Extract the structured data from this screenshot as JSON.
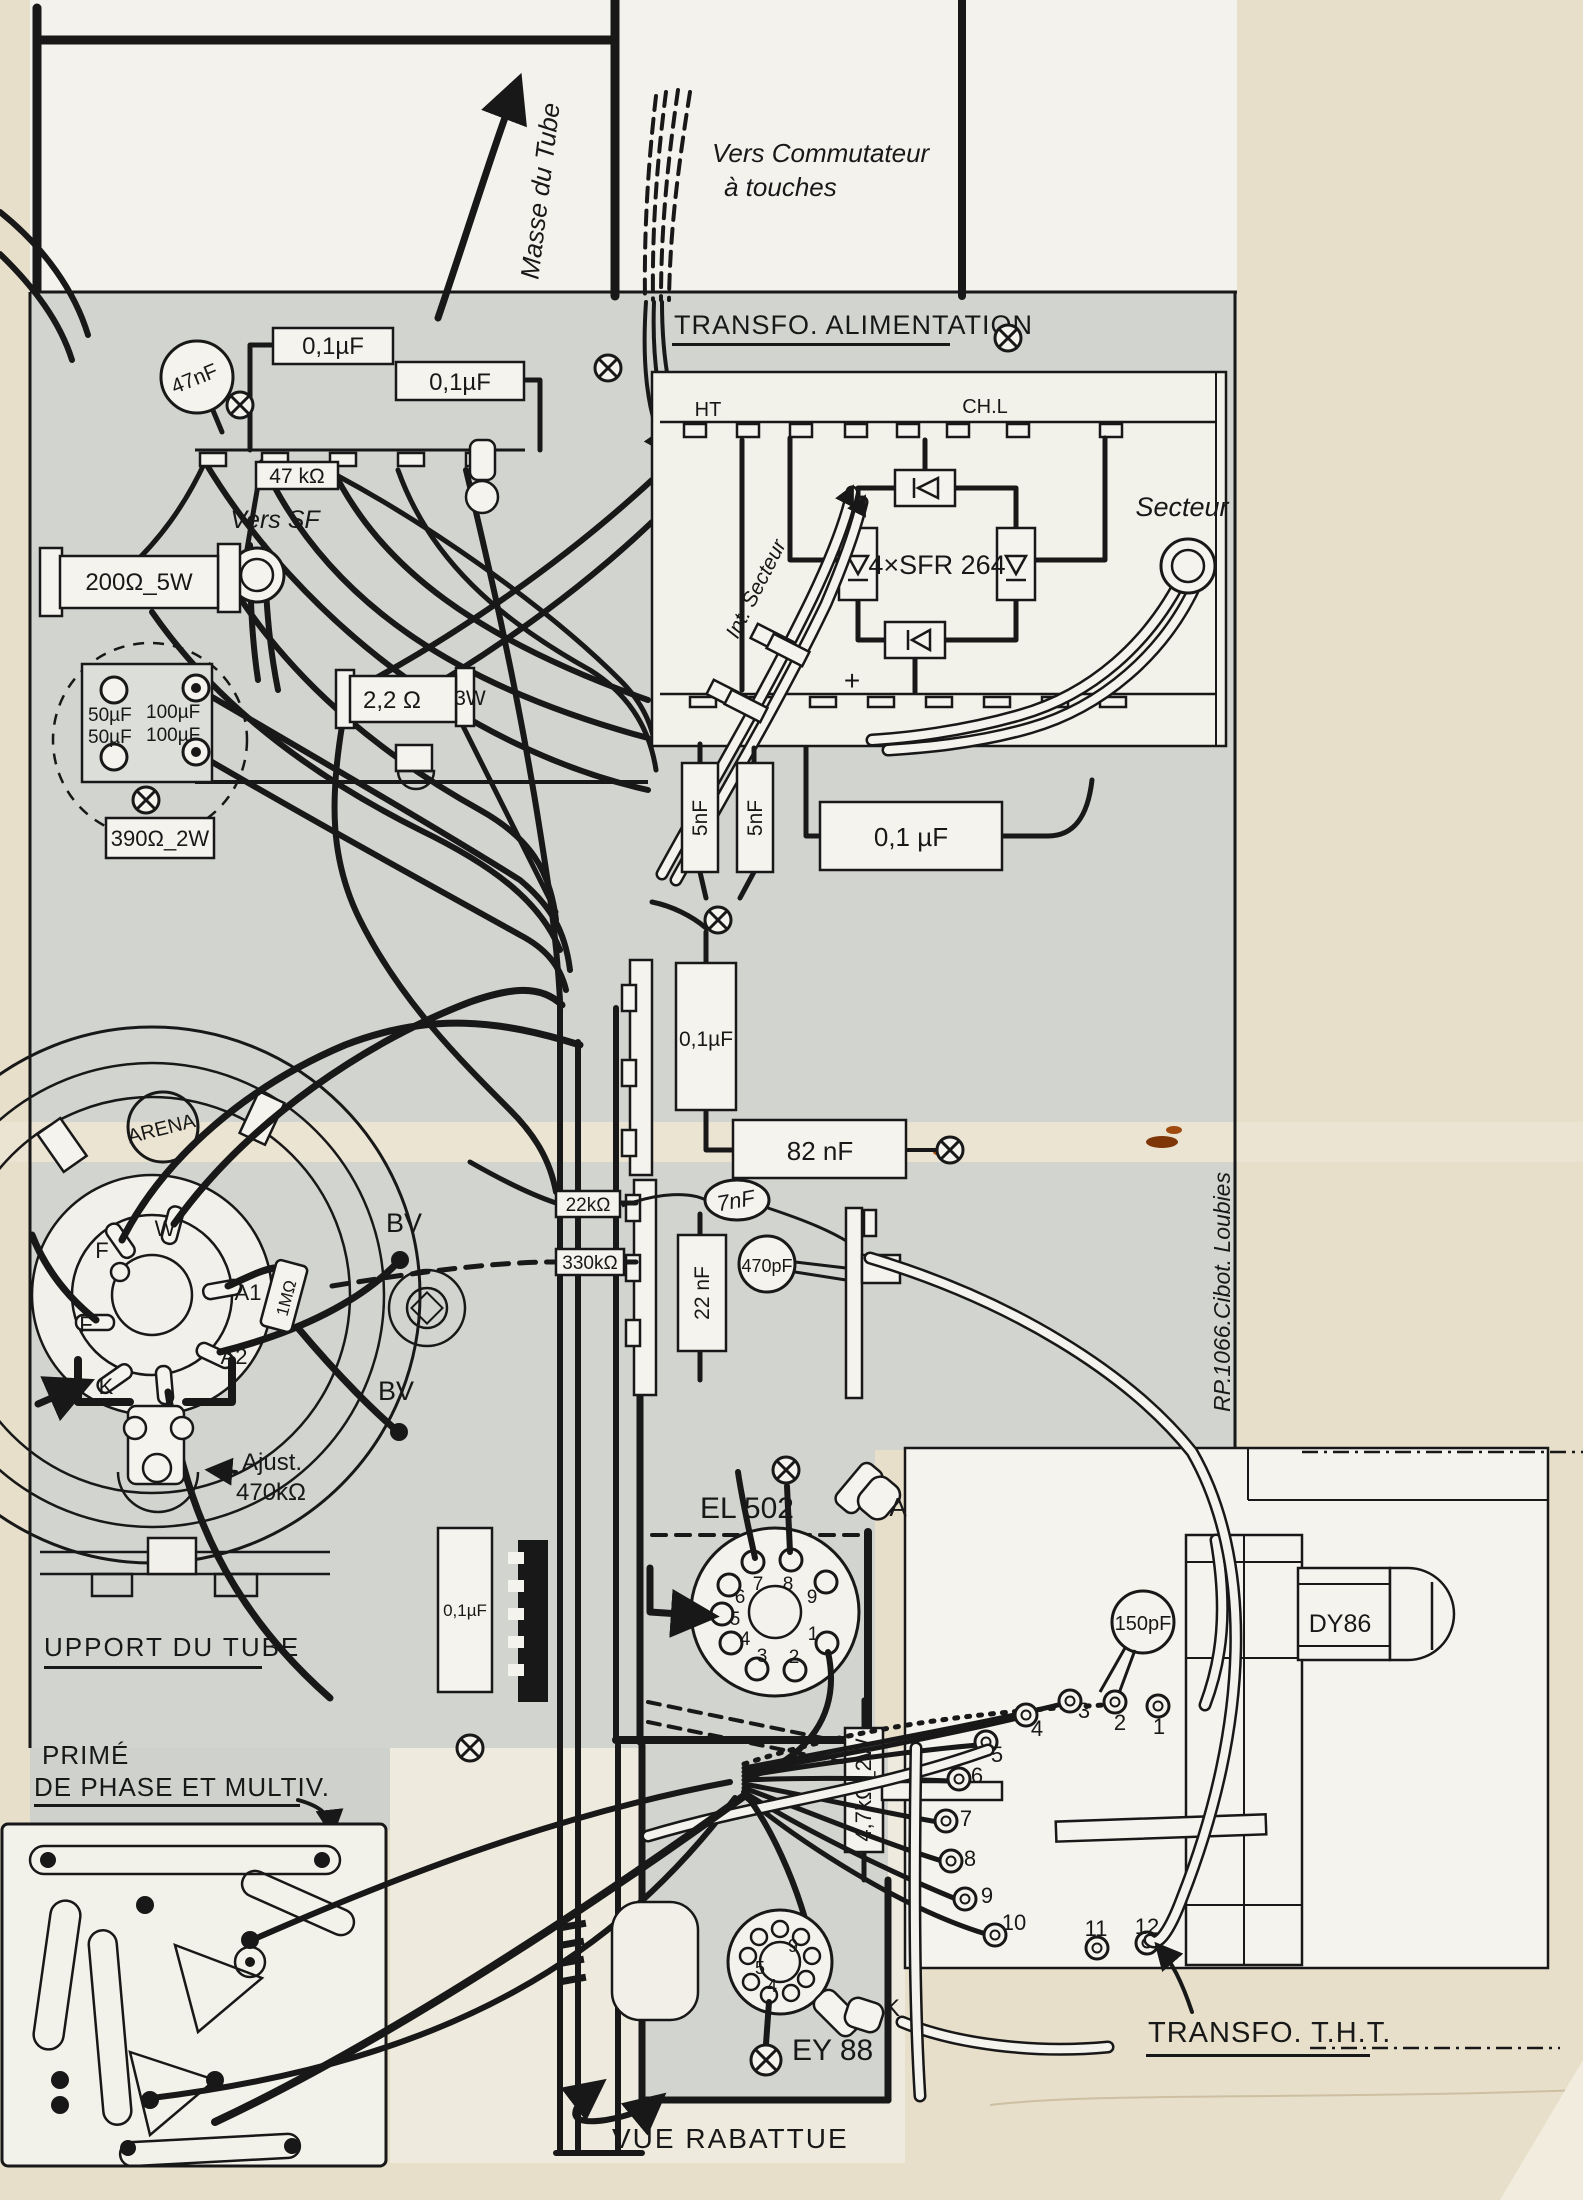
{
  "credit": "RP.1066.Cibot. Loubies",
  "top": {
    "masse": "Masse du Tube",
    "vers1": "Vers Commutateur",
    "vers2": "à touches"
  },
  "power": {
    "title": "TRANSFO. ALIMENTATION",
    "ht": "HT",
    "chl": "CH.L",
    "bridge": "4×SFR 264",
    "plus": "+",
    "int_secteur": "Int. Secteur",
    "secteur": "Secteur"
  },
  "tl": {
    "c47nf": "47nF",
    "c01a": "0,1µF",
    "c01b": "0,1µF",
    "r47k": "47 kΩ",
    "vers_sf": "Vers SF",
    "r200": "200Ω_5W",
    "c50a": "50µF",
    "c50b": "50µF",
    "c100a": "100µF",
    "c100b": "100µF",
    "r390": "390Ω_2W",
    "r22": "2,2 Ω",
    "r22w": "3W"
  },
  "mid": {
    "c5a": "5nF",
    "c5b": "5nF",
    "c01big": "0,1 µF",
    "c01v": "0,1µF",
    "c82": "82 nF",
    "r22k": "22kΩ",
    "r330k": "330kΩ",
    "c7": "7nF",
    "c470": "470pF",
    "c22n": "22 nF",
    "c01low": "0,1µF"
  },
  "crt": {
    "arena": "ARENA",
    "bv1": "BV",
    "bv2": "BV",
    "f1": "F",
    "w": "W",
    "a1": "A1",
    "a2": "A2",
    "k": "K",
    "f2": "F",
    "r1m": "1MΩ",
    "aj1": "Ajust.",
    "aj2": "470kΩ",
    "support": "UPPORT DU TUBE"
  },
  "pcb": {
    "l1": "PRIMÉ",
    "l2": "DE PHASE ET MULTIV."
  },
  "el": {
    "label": "EL 502",
    "a": "A",
    "pins": [
      "1",
      "2",
      "3",
      "4",
      "5",
      "6",
      "7",
      "8",
      "9"
    ]
  },
  "tht": {
    "title": "TRANSFO. T.H.T.",
    "r47k": "4,7kΩ_2W",
    "c150": "150pF",
    "dy86": "DY86",
    "pins": [
      "1",
      "2",
      "3",
      "4",
      "5",
      "6",
      "7",
      "8",
      "9",
      "10",
      "11",
      "12"
    ]
  },
  "ey": {
    "label": "EY 88",
    "k": "K",
    "p9": "9",
    "p5": "5",
    "p4": "4"
  },
  "misc": {
    "vue": "VUE RABATTUE"
  }
}
